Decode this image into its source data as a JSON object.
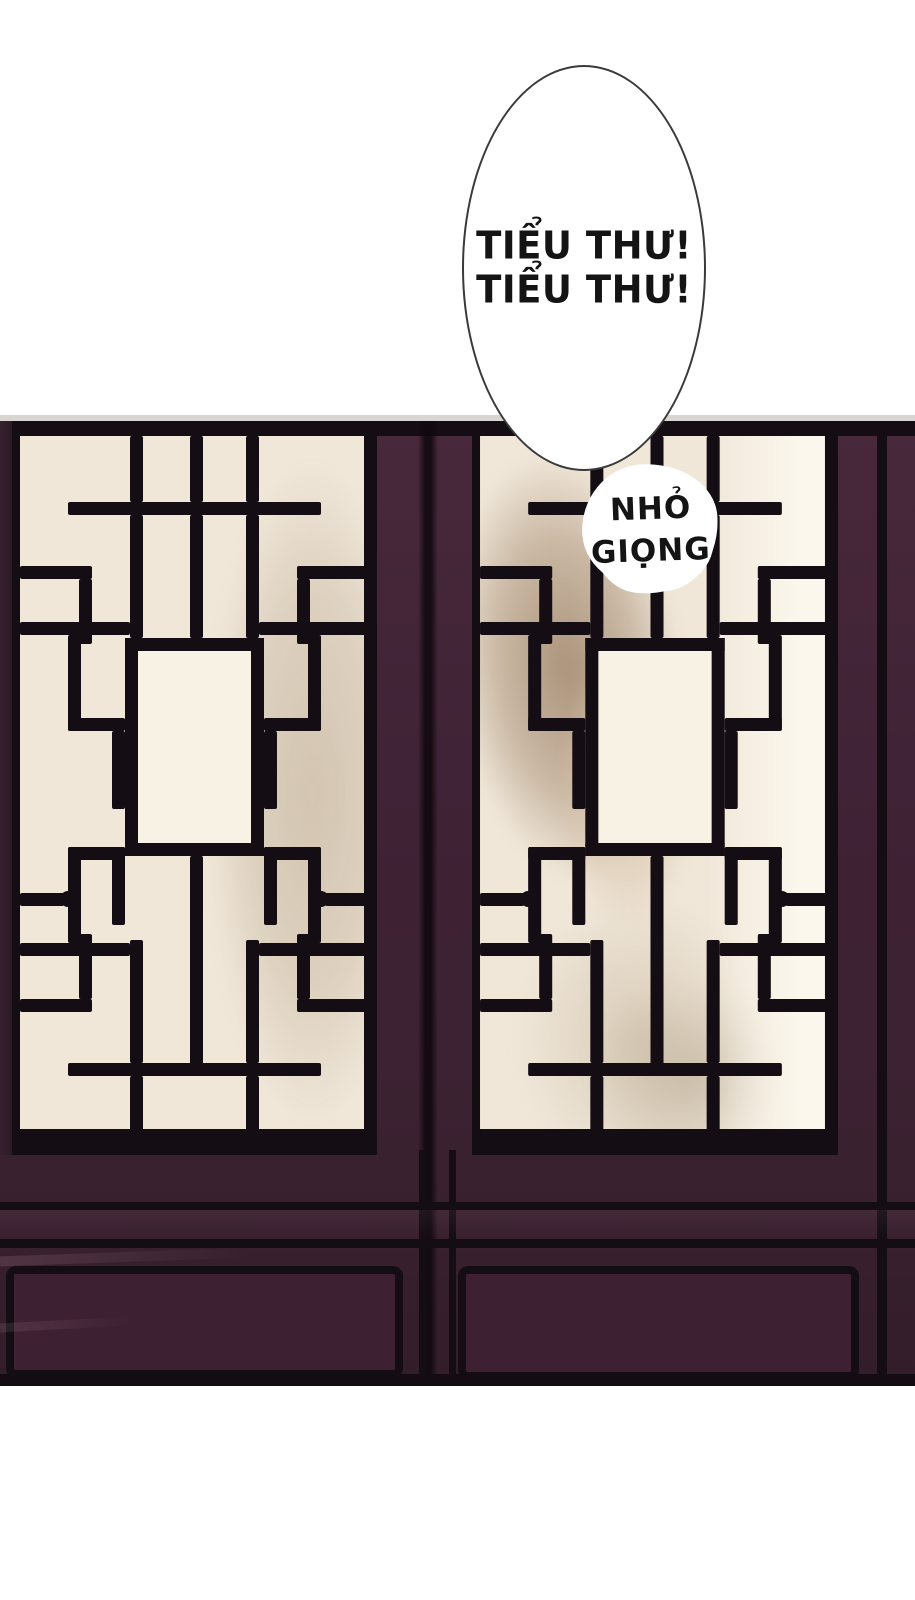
{
  "speech_bubble": {
    "lines": [
      "TIỂU THƯ!",
      "TIỂU THƯ!"
    ]
  },
  "sfx_bubble": {
    "lines": [
      "NHỎ",
      "GIỌNG"
    ]
  },
  "colors": {
    "paper": "#ffffff",
    "grey-strip": "#d8d5d2",
    "wood": "#402336",
    "wood-light": "#4a2a3c",
    "wood-dark": "#301c28",
    "ink": "#140d14",
    "cream": "#f0e7d9",
    "cartouche": "#f8f2e5",
    "panel": "#3d2132",
    "bubble-border": "#3a3a3a",
    "text": "#141414",
    "hair": "#9b7d61",
    "skin": "#d8c3ad",
    "shade": "#b4a28c"
  }
}
